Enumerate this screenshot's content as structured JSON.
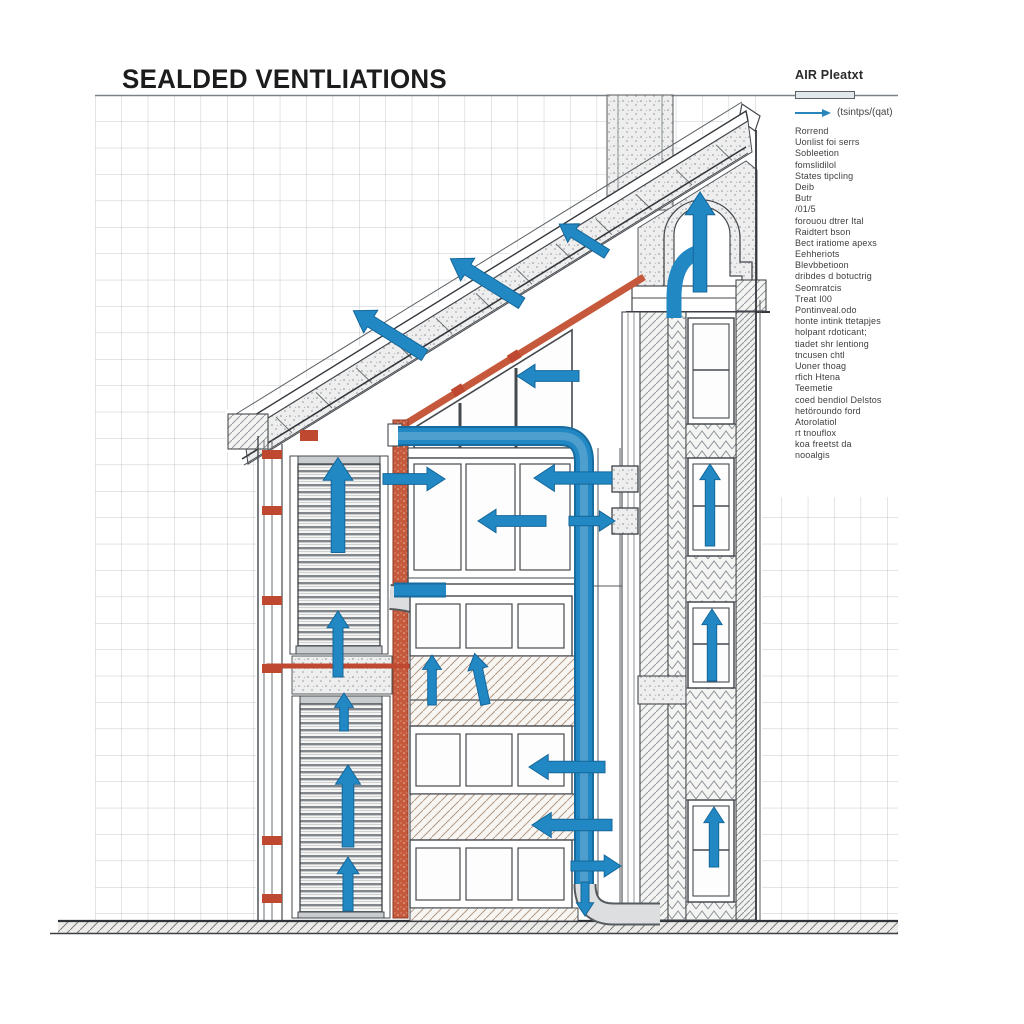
{
  "title": "SEALDED VENTLIATIONS",
  "legend": {
    "header": "AIR Pleatxt",
    "bar_symbol": "duct-section-bar",
    "arrow_symbol": "airflow-arrow",
    "arrow_label": "(tsintps/(qat)",
    "items": [
      "Rorrend",
      "Uonlist foi serrs",
      "Sobleetion",
      "fomslidilol",
      "States tipcling",
      "Deib",
      "Butr",
      "/01/5",
      "forouou dtrer Ital",
      "Raidtert bson",
      "Bect iratiome apexs",
      "Eehheriots",
      "Blevbbetioon",
      "dribdes d botuctrig",
      "Seomratcis",
      "Treat I00",
      "Pontinveal.odo",
      "honte intink ttetapjes",
      "holpant rdoticant;",
      "tiadet shr lentiong",
      "tncusen chtl",
      "Uoner thoag",
      "rfich Htena",
      "Teemetie",
      "coed bendiol Delstos",
      "hetöroundo ford",
      "Atorolatiol",
      "rt tnouflox",
      "koa freetst da",
      "nooalgis"
    ]
  },
  "colors": {
    "airflow_blue": "#2188c4",
    "airflow_blue_dark": "#15679a",
    "insulation_orange": "#c6593c",
    "clamp_red": "#bf4930",
    "grid_line": "#c6c9cc",
    "ink": "#4a4f54"
  },
  "drawing": {
    "arrows": [
      {
        "name": "roof-flow-arrow-upper",
        "x": 583,
        "y": 239,
        "len": 56,
        "w": 14,
        "angle": 212
      },
      {
        "name": "roof-flow-arrow-mid",
        "x": 486,
        "y": 281,
        "len": 84,
        "w": 17,
        "angle": 212
      },
      {
        "name": "roof-flow-arrow-lower",
        "x": 389,
        "y": 333,
        "len": 84,
        "w": 17,
        "angle": 212
      },
      {
        "name": "ridge-exhaust-arrow",
        "x": 700,
        "y": 242,
        "len": 100,
        "w": 19,
        "angle": 270
      },
      {
        "name": "louver-upper-up-arrow-1",
        "x": 338,
        "y": 505,
        "len": 95,
        "w": 19,
        "angle": 270
      },
      {
        "name": "louver-upper-up-arrow-2",
        "x": 338,
        "y": 644,
        "len": 66,
        "w": 14,
        "angle": 270
      },
      {
        "name": "louver-upper-up-arrow-3",
        "x": 344,
        "y": 712,
        "len": 38,
        "w": 12,
        "angle": 270
      },
      {
        "name": "louver-lower-up-arrow-1",
        "x": 348,
        "y": 806,
        "len": 82,
        "w": 16,
        "angle": 270
      },
      {
        "name": "louver-lower-up-arrow-2",
        "x": 348,
        "y": 884,
        "len": 54,
        "w": 14,
        "angle": 270
      },
      {
        "name": "attic-room-in-arrow",
        "x": 548,
        "y": 376,
        "len": 62,
        "w": 15,
        "angle": 180
      },
      {
        "name": "floor2-in-left-arrow",
        "x": 414,
        "y": 479,
        "len": 62,
        "w": 15,
        "angle": 0
      },
      {
        "name": "floor2-in-right-arrow",
        "x": 573,
        "y": 478,
        "len": 78,
        "w": 17,
        "angle": 180
      },
      {
        "name": "floor2-in-mid-arrow",
        "x": 512,
        "y": 521,
        "len": 68,
        "w": 15,
        "angle": 180
      },
      {
        "name": "floor2-vent-out-arrow",
        "x": 592,
        "y": 521,
        "len": 46,
        "w": 13,
        "angle": 0
      },
      {
        "name": "spandrel-up-arrow-1",
        "x": 432,
        "y": 680,
        "len": 50,
        "w": 12,
        "angle": 270
      },
      {
        "name": "spandrel-up-arrow-2",
        "x": 480,
        "y": 679,
        "len": 52,
        "w": 13,
        "angle": 258
      },
      {
        "name": "floor4-in-arrow",
        "x": 567,
        "y": 767,
        "len": 76,
        "w": 16,
        "angle": 180
      },
      {
        "name": "floor4-spandrel-in-arrow",
        "x": 572,
        "y": 825,
        "len": 80,
        "w": 16,
        "angle": 180
      },
      {
        "name": "floor5-out-arrow",
        "x": 596,
        "y": 866,
        "len": 50,
        "w": 14,
        "angle": 0
      },
      {
        "name": "duct-down-arrow",
        "x": 585,
        "y": 899,
        "len": 34,
        "w": 11,
        "angle": 90
      },
      {
        "name": "right-bay-up-arrow-1",
        "x": 710,
        "y": 505,
        "len": 82,
        "w": 13,
        "angle": 270
      },
      {
        "name": "right-bay-up-arrow-2",
        "x": 712,
        "y": 645,
        "len": 72,
        "w": 13,
        "angle": 270
      },
      {
        "name": "right-bay-up-arrow-3",
        "x": 714,
        "y": 837,
        "len": 60,
        "w": 13,
        "angle": 270
      }
    ]
  }
}
